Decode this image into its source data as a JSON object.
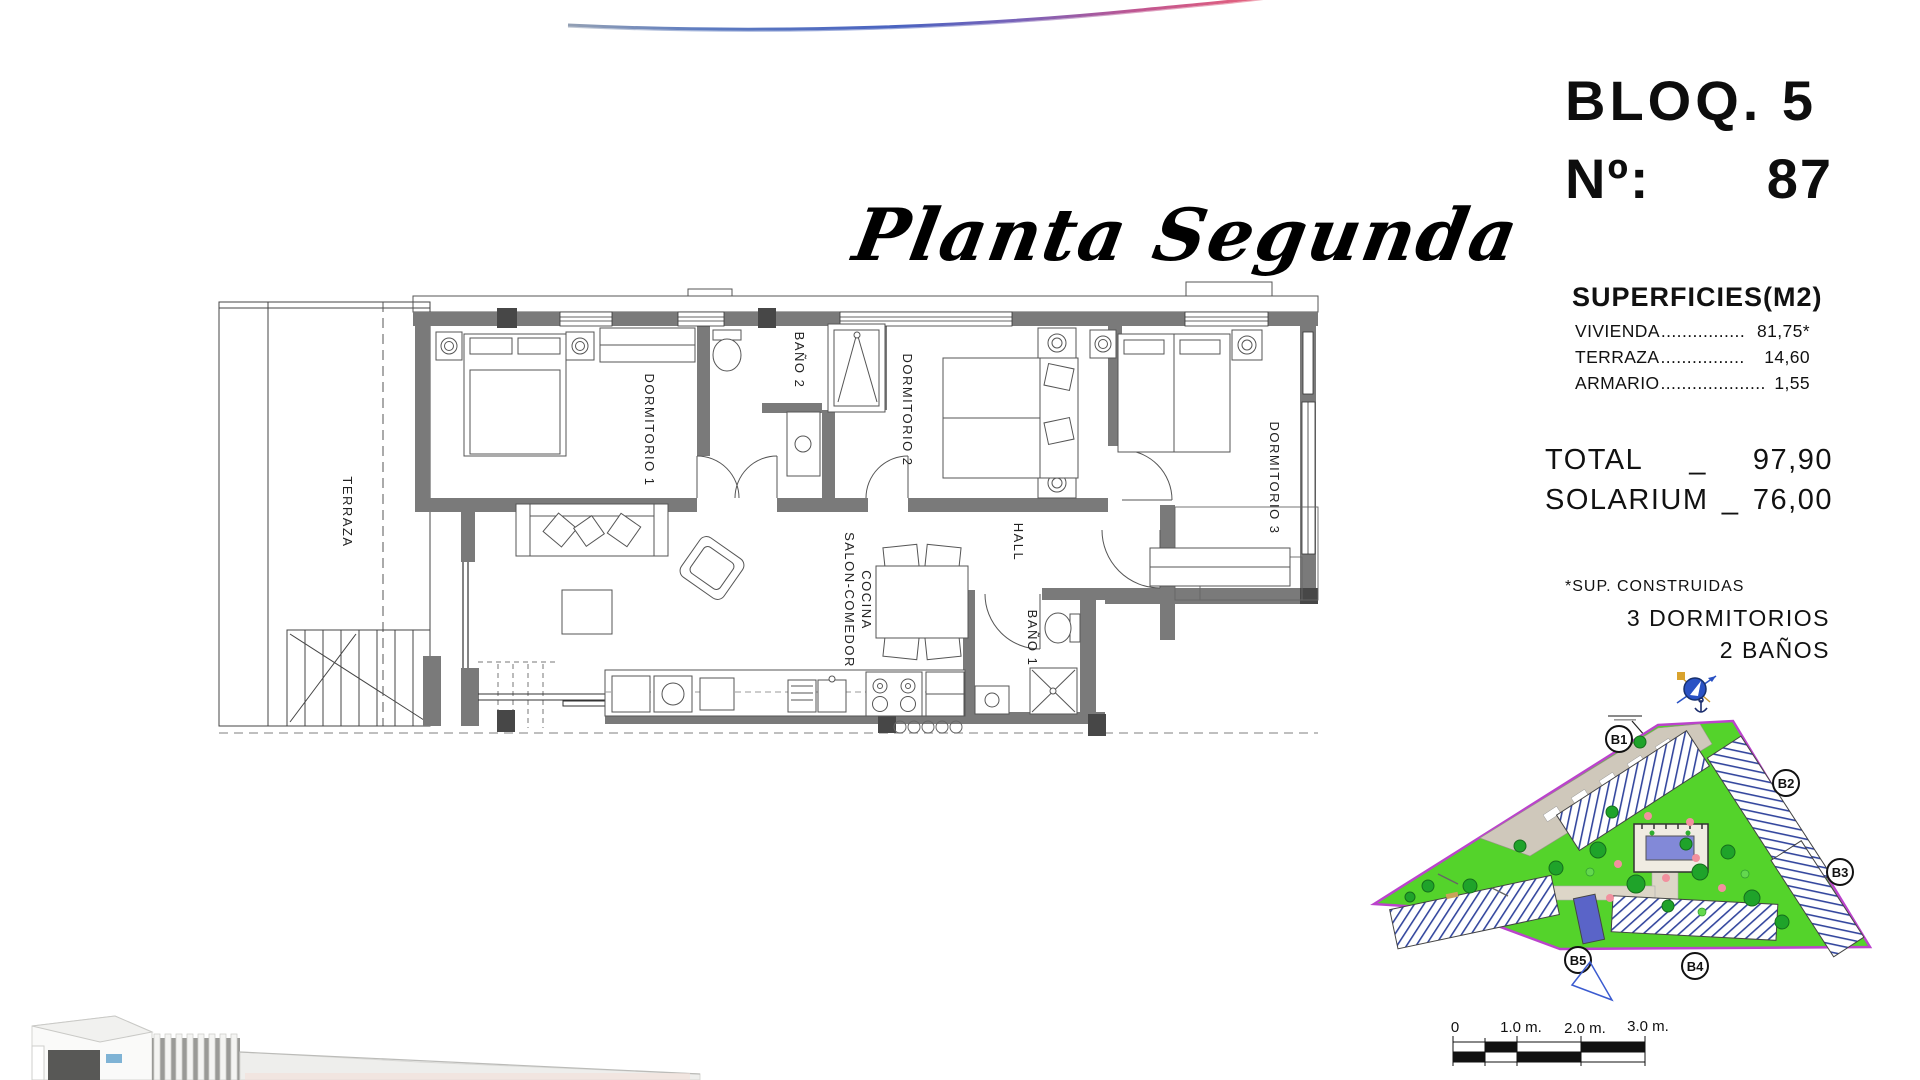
{
  "header": {
    "plan_title": "Planta Segunda",
    "block_label": "BLOQ. 5",
    "unit_label": "Nº:",
    "unit_number": "87"
  },
  "surfaces": {
    "heading": "SUPERFICIES(M2)",
    "rows": {
      "vivienda": {
        "label": "VIVIENDA",
        "dots": "................",
        "value": "81,75*"
      },
      "terraza": {
        "label": "TERRAZA",
        "dots": "................",
        "value": "14,60"
      },
      "armario": {
        "label": "ARMARIO",
        "dots": "....................",
        "value": "1,55"
      }
    },
    "total": {
      "label": "TOTAL",
      "sep": "_",
      "value": "97,90"
    },
    "solarium": {
      "label": "SOLARIUM",
      "sep": "_",
      "value": "76,00"
    },
    "footnote": "*SUP. CONSTRUIDAS",
    "bedrooms": "3 DORMITORIOS",
    "bathrooms": "2 BAÑOS"
  },
  "floor_plan": {
    "rooms": {
      "terraza": "TERRAZA",
      "dormitorio1": "DORMITORIO 1",
      "bano2": "BAÑO 2",
      "dormitorio2": "DORMITORIO 2",
      "dormitorio3": "DORMITORIO 3",
      "salon_line1": "SALON-COMEDOR",
      "salon_line2": "COCINA",
      "hall": "HALL",
      "bano1": "BAÑO 1"
    }
  },
  "site_plan": {
    "blocks": {
      "b1": "B1",
      "b2": "B2",
      "b3": "B3",
      "b4": "B4",
      "b5": "B5"
    }
  },
  "scale_bar": {
    "m0": "0",
    "m1": "1.0 m.",
    "m2": "2.0 m.",
    "m3": "3.0 m."
  },
  "colors": {
    "lawn_green": "#54d32b",
    "tree_green": "#1fa32a",
    "boundary_purple": "#bb43cc",
    "pool_blue": "#8289d8",
    "road_beige": "#cfc8bb",
    "wall_gray": "#7a7a7a",
    "swoosh_blue": "#4a63c0",
    "swoosh_pink": "#e0607f",
    "compass_blue": "#2a52c4"
  }
}
